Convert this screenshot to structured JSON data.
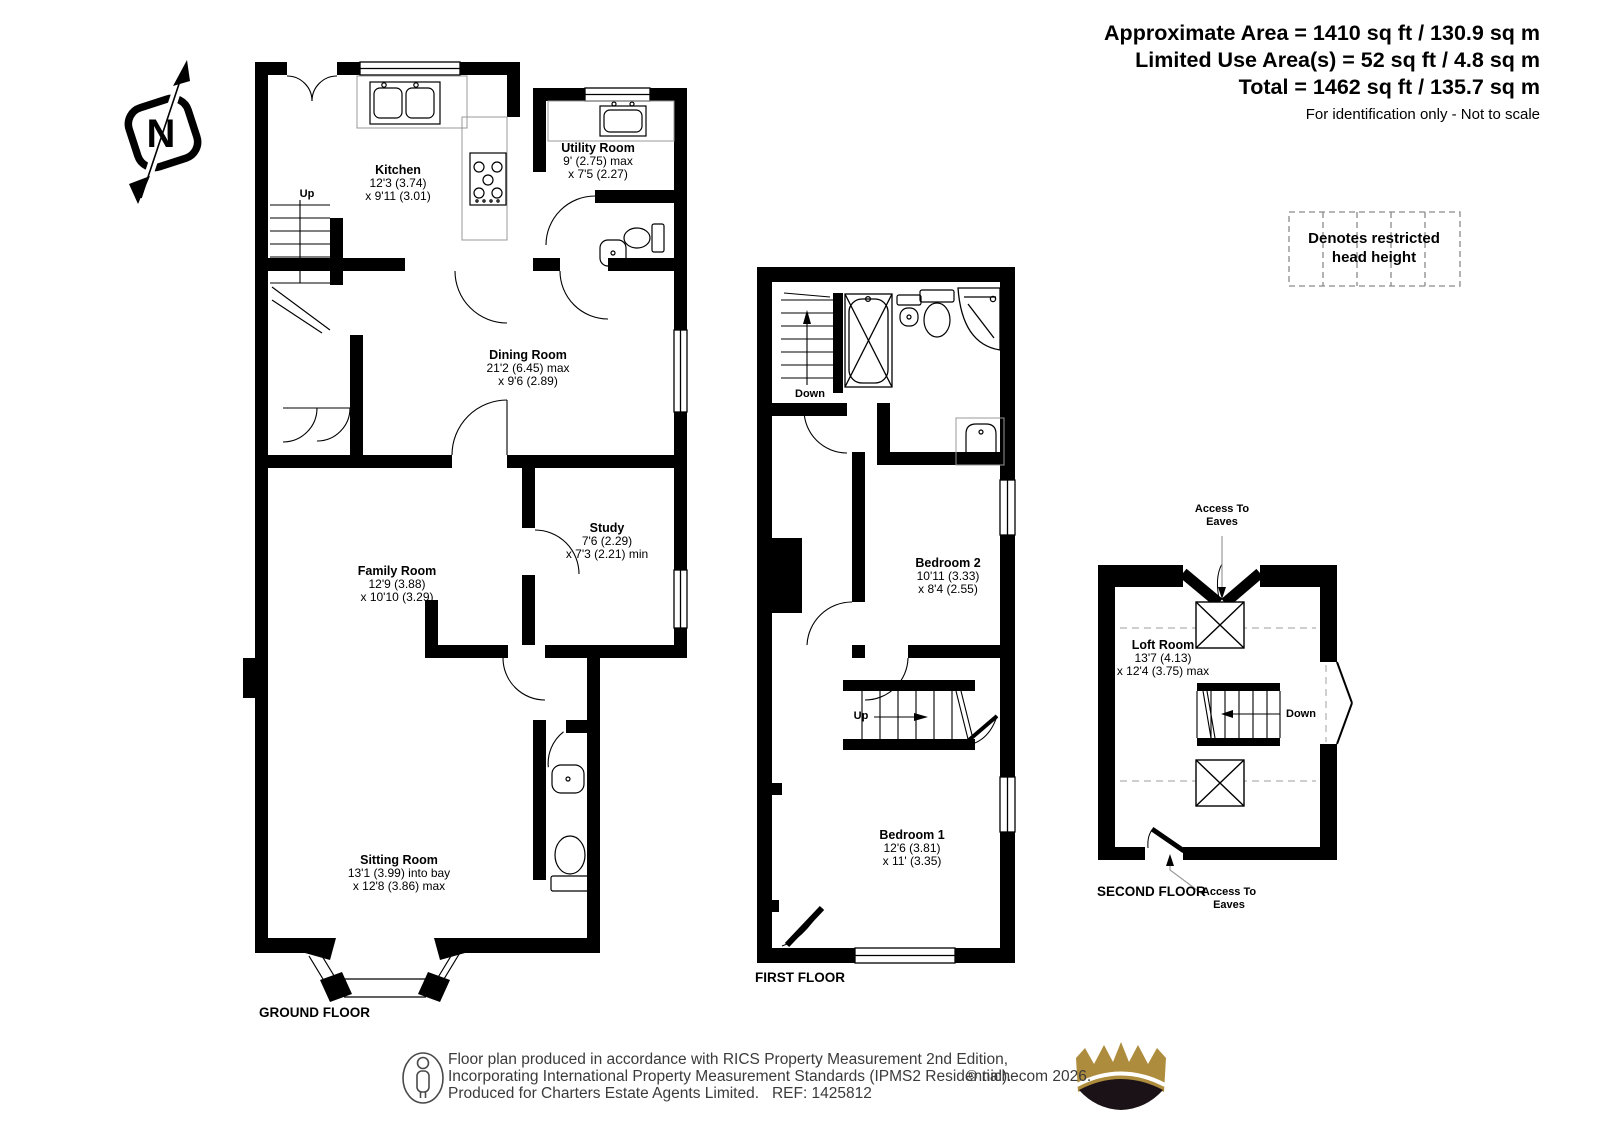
{
  "header": {
    "line1": "Approximate Area = 1410 sq ft / 130.9 sq m",
    "line2": "Limited Use Area(s) = 52 sq ft / 4.8 sq m",
    "line3": "Total = 1462 sq ft / 135.7 sq m",
    "note": "For identification only - Not to scale"
  },
  "legend": {
    "line1": "Denotes restricted",
    "line2": "head height"
  },
  "compass": {
    "letter": "N"
  },
  "ground": {
    "floor_label": "GROUND FLOOR",
    "up_label": "Up",
    "kitchen": {
      "name": "Kitchen",
      "d1": "12'3 (3.74)",
      "d2": "x 9'11 (3.01)"
    },
    "utility": {
      "name": "Utility Room",
      "d1": "9' (2.75) max",
      "d2": "x 7'5 (2.27)"
    },
    "dining": {
      "name": "Dining Room",
      "d1": "21'2 (6.45) max",
      "d2": "x 9'6 (2.89)"
    },
    "study": {
      "name": "Study",
      "d1": "7'6 (2.29)",
      "d2": "x 7'3 (2.21) min"
    },
    "family": {
      "name": "Family Room",
      "d1": "12'9 (3.88)",
      "d2": "x 10'10 (3.29)"
    },
    "sitting": {
      "name": "Sitting Room",
      "d1": "13'1 (3.99) into bay",
      "d2": "x 12'8 (3.86) max"
    }
  },
  "first": {
    "floor_label": "FIRST FLOOR",
    "down_label": "Down",
    "up_label": "Up",
    "bedroom2": {
      "name": "Bedroom 2",
      "d1": "10'11 (3.33)",
      "d2": "x 8'4 (2.55)"
    },
    "bedroom1": {
      "name": "Bedroom 1",
      "d1": "12'6 (3.81)",
      "d2": "x 11' (3.35)"
    }
  },
  "second": {
    "floor_label": "SECOND FLOOR",
    "down_label": "Down",
    "access_top": "Access To Eaves",
    "access_bottom": "Access To Eaves",
    "loft": {
      "name": "Loft Room",
      "d1": "13'7 (4.13)",
      "d2": "x 12'4 (3.75) max"
    }
  },
  "footer": {
    "line1": "Floor plan produced in accordance with RICS Property Measurement 2nd Edition,",
    "line2": "Incorporating International Property Measurement Standards (IPMS2 Residential).",
    "copyright": "© nichecom 2026.",
    "line3": "Produced for Charters Estate Agents Limited.   REF: 1425812"
  },
  "colors": {
    "wall": "#000000",
    "crown_gold": "#AE8C3D",
    "crown_base": "#1a1216"
  }
}
